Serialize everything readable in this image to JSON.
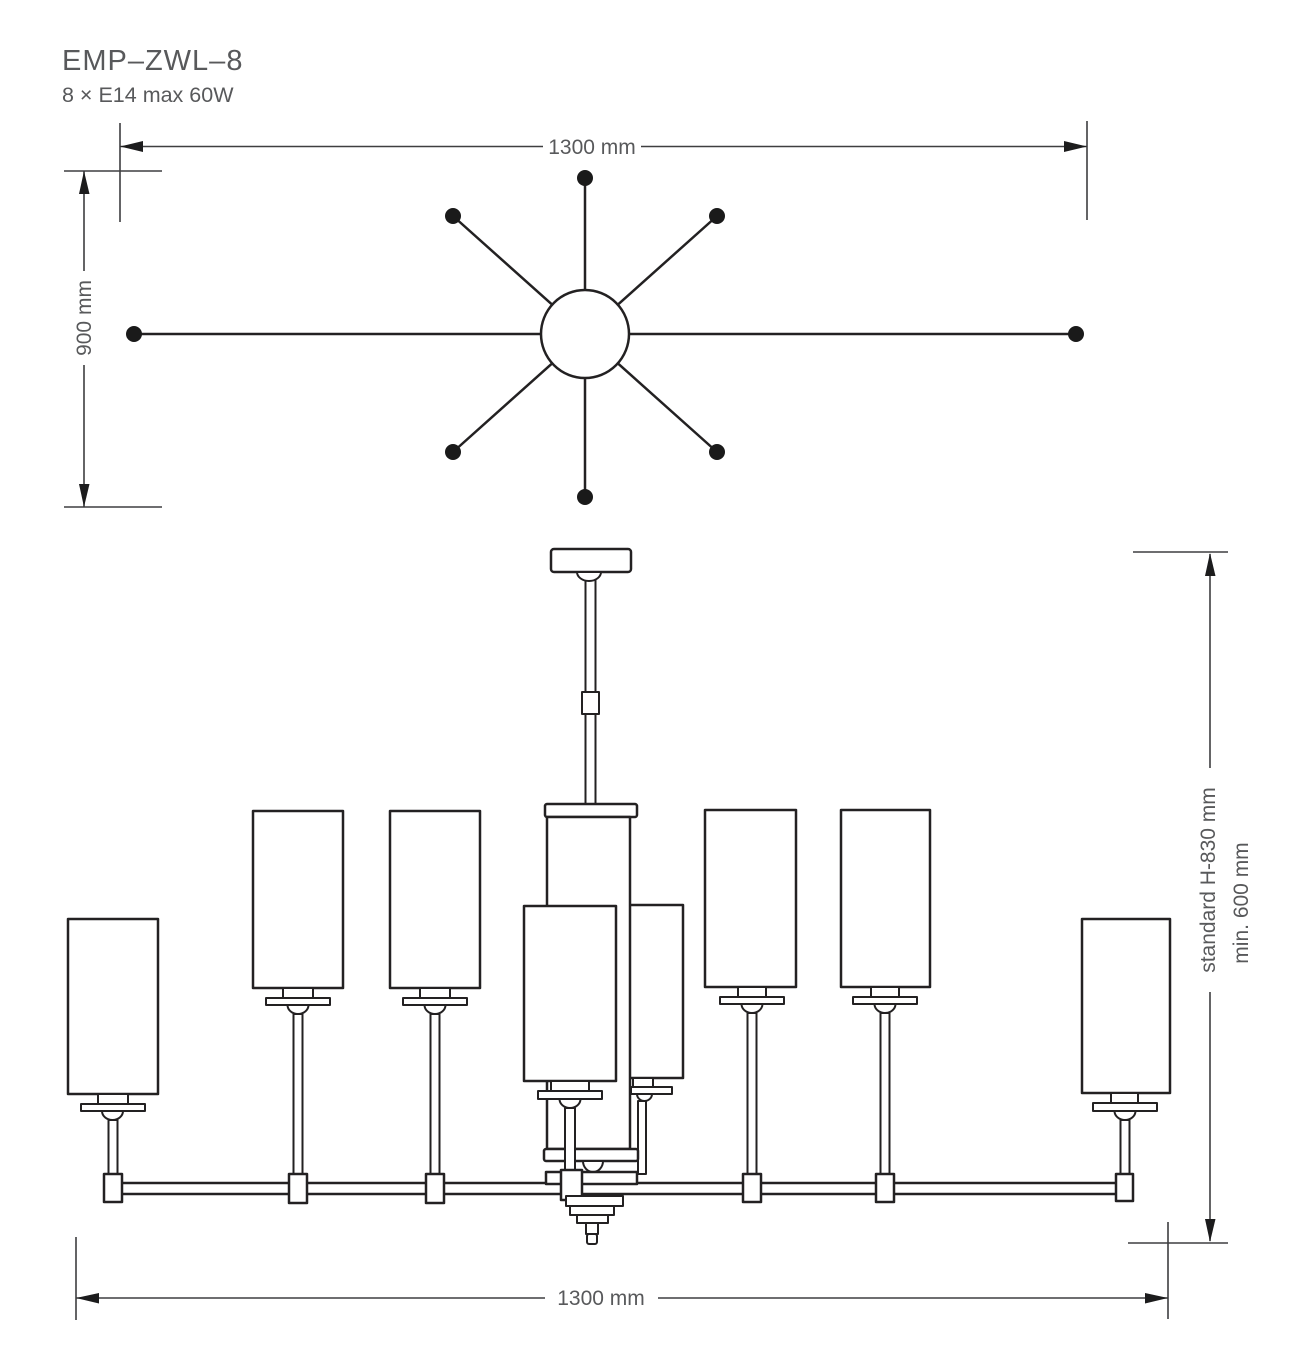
{
  "header": {
    "product_code": "EMP–ZWL–8",
    "lamp_spec": "8 × E14 max 60W"
  },
  "top_view": {
    "width_dim": "1300 mm",
    "depth_dim": "900 mm",
    "arm_count": 8
  },
  "side_view": {
    "height_dim": "standard H-830 mm",
    "min_height_dim": "min. 600 mm",
    "width_dim": "1300 mm",
    "shade_count": 8
  },
  "colors": {
    "line": "#232122",
    "dimension": "#3e3e40",
    "text": "#58595b",
    "background": "#ffffff"
  }
}
